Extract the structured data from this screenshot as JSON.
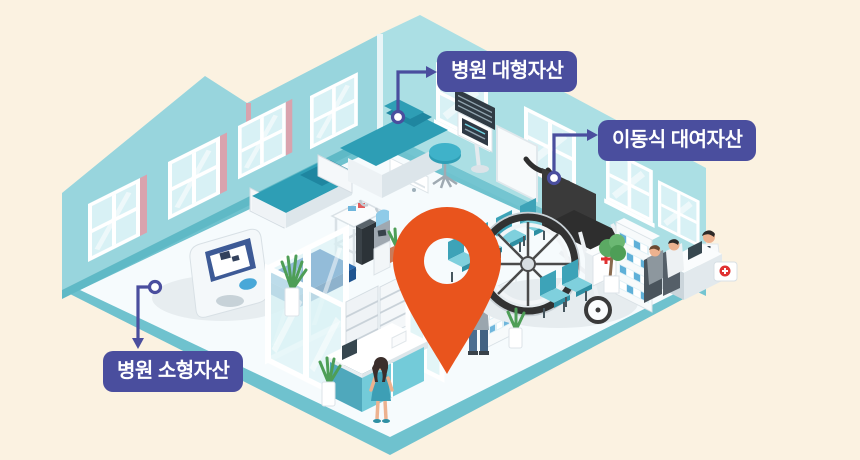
{
  "scene": {
    "description_name": "isometric-hospital-asset-map",
    "background_color": "#FBF2E1",
    "label_color": "#4A4E9E",
    "pin_color": "#E9541D",
    "wall_color": "#98D5DD",
    "floor_color": "#F6FBFD",
    "floor_edge_color": "#6FC2CE",
    "objects": [
      "location-pin",
      "examination-bed",
      "hospital-bed",
      "wheelchair",
      "blood-pressure-monitor",
      "reception-desk",
      "pharmacy-shelf",
      "waiting-chairs"
    ]
  },
  "labels": [
    {
      "id": "hospital-large-assets",
      "text": "병원 대형자산"
    },
    {
      "id": "mobile-rental-assets",
      "text": "이동식 대여자산"
    },
    {
      "id": "hospital-small-assets",
      "text": "병원 소형자산"
    }
  ]
}
